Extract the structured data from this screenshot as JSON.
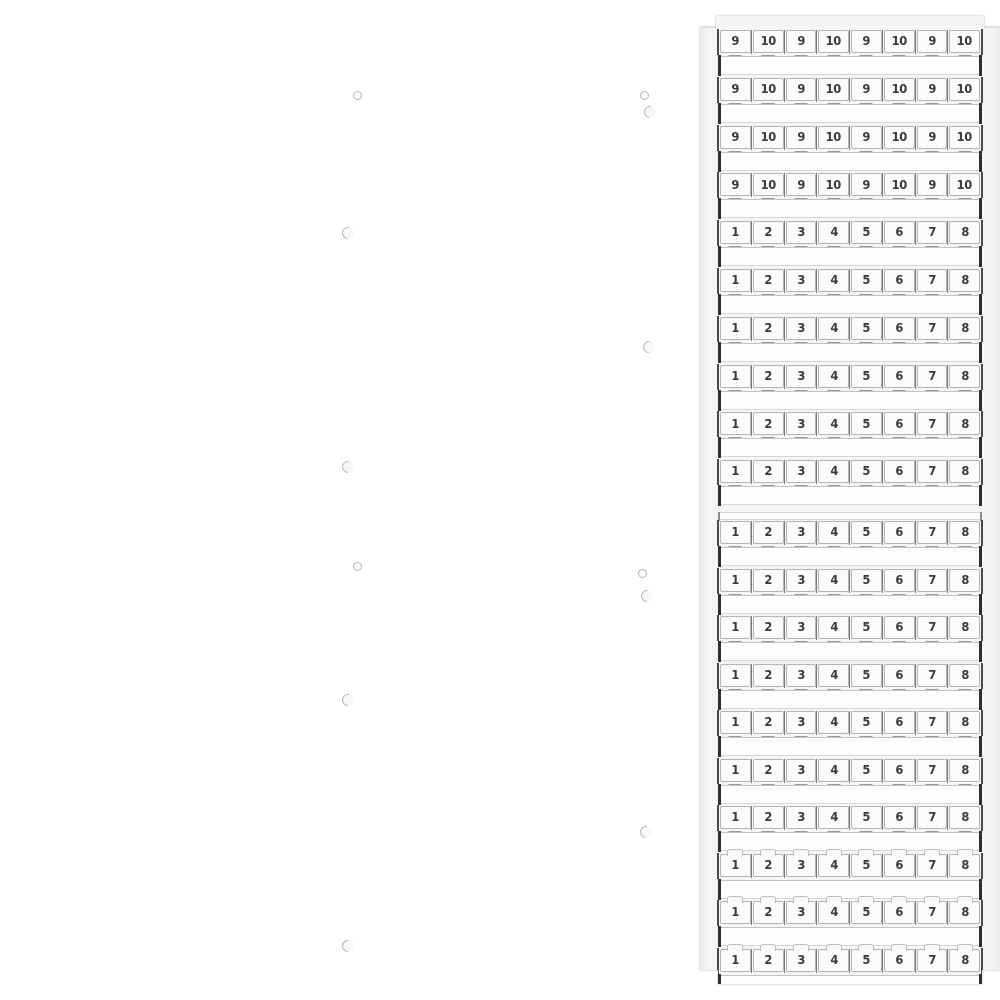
{
  "description": "Product photo of a white terminal-block marker card with rows of snap-off numbered marker tags",
  "colors": {
    "background": "#ffffff",
    "card_body": "#f5f5f3",
    "tag_face": "#fbfbfa",
    "tag_border": "#b4b4b2",
    "divider": "#787876",
    "digit": "#3a3a38",
    "blank_face": "#fdfdfc",
    "blank_border": "#d6d6d4",
    "end_tick": "#2f2f2d",
    "notch_mark": "#9a9a98",
    "rail_mark": "#b5b5b3"
  },
  "card": {
    "sections": [
      {
        "name": "upper-card",
        "rows": [
          {
            "notch": "below",
            "labels": [
              "9",
              "10",
              "9",
              "10",
              "9",
              "10",
              "9",
              "10"
            ]
          },
          {
            "notch": "below",
            "labels": [
              "9",
              "10",
              "9",
              "10",
              "9",
              "10",
              "9",
              "10"
            ]
          },
          {
            "notch": "below",
            "labels": [
              "9",
              "10",
              "9",
              "10",
              "9",
              "10",
              "9",
              "10"
            ]
          },
          {
            "notch": "below",
            "labels": [
              "9",
              "10",
              "9",
              "10",
              "9",
              "10",
              "9",
              "10"
            ]
          },
          {
            "notch": "below",
            "labels": [
              "1",
              "2",
              "3",
              "4",
              "5",
              "6",
              "7",
              "8"
            ]
          },
          {
            "notch": "below",
            "labels": [
              "1",
              "2",
              "3",
              "4",
              "5",
              "6",
              "7",
              "8"
            ]
          },
          {
            "notch": "below",
            "labels": [
              "1",
              "2",
              "3",
              "4",
              "5",
              "6",
              "7",
              "8"
            ]
          },
          {
            "notch": "below",
            "labels": [
              "1",
              "2",
              "3",
              "4",
              "5",
              "6",
              "7",
              "8"
            ]
          },
          {
            "notch": "below",
            "labels": [
              "1",
              "2",
              "3",
              "4",
              "5",
              "6",
              "7",
              "8"
            ]
          },
          {
            "notch": "below",
            "labels": [
              "1",
              "2",
              "3",
              "4",
              "5",
              "6",
              "7",
              "8"
            ]
          }
        ]
      },
      {
        "name": "lower-card",
        "rows": [
          {
            "notch": "below",
            "labels": [
              "1",
              "2",
              "3",
              "4",
              "5",
              "6",
              "7",
              "8"
            ]
          },
          {
            "notch": "below",
            "labels": [
              "1",
              "2",
              "3",
              "4",
              "5",
              "6",
              "7",
              "8"
            ]
          },
          {
            "notch": "below",
            "labels": [
              "1",
              "2",
              "3",
              "4",
              "5",
              "6",
              "7",
              "8"
            ]
          },
          {
            "notch": "below",
            "labels": [
              "1",
              "2",
              "3",
              "4",
              "5",
              "6",
              "7",
              "8"
            ]
          },
          {
            "notch": "below",
            "labels": [
              "1",
              "2",
              "3",
              "4",
              "5",
              "6",
              "7",
              "8"
            ]
          },
          {
            "notch": "below",
            "labels": [
              "1",
              "2",
              "3",
              "4",
              "5",
              "6",
              "7",
              "8"
            ]
          },
          {
            "notch": "below",
            "labels": [
              "1",
              "2",
              "3",
              "4",
              "5",
              "6",
              "7",
              "8"
            ]
          },
          {
            "notch": "above",
            "labels": [
              "1",
              "2",
              "3",
              "4",
              "5",
              "6",
              "7",
              "8"
            ]
          },
          {
            "notch": "above",
            "labels": [
              "1",
              "2",
              "3",
              "4",
              "5",
              "6",
              "7",
              "8"
            ]
          },
          {
            "notch": "above",
            "labels": [
              "1",
              "2",
              "3",
              "4",
              "5",
              "6",
              "7",
              "8"
            ]
          }
        ]
      }
    ],
    "mount_marks": [
      {
        "type": "hole",
        "side": "left",
        "x": 353,
        "y": 91
      },
      {
        "type": "hole",
        "side": "right",
        "x": 640,
        "y": 91
      },
      {
        "type": "swirl",
        "side": "right",
        "x": 644,
        "y": 106
      },
      {
        "type": "swirl",
        "side": "left",
        "x": 342,
        "y": 227
      },
      {
        "type": "swirl",
        "side": "right",
        "x": 643,
        "y": 341
      },
      {
        "type": "swirl",
        "side": "left",
        "x": 342,
        "y": 461
      },
      {
        "type": "hole",
        "side": "left",
        "x": 353,
        "y": 562
      },
      {
        "type": "hole",
        "side": "right",
        "x": 638,
        "y": 569
      },
      {
        "type": "swirl",
        "side": "right",
        "x": 641,
        "y": 590
      },
      {
        "type": "swirl",
        "side": "left",
        "x": 342,
        "y": 694
      },
      {
        "type": "swirl",
        "side": "right",
        "x": 640,
        "y": 826
      },
      {
        "type": "swirl",
        "side": "left",
        "x": 342,
        "y": 940
      }
    ]
  }
}
